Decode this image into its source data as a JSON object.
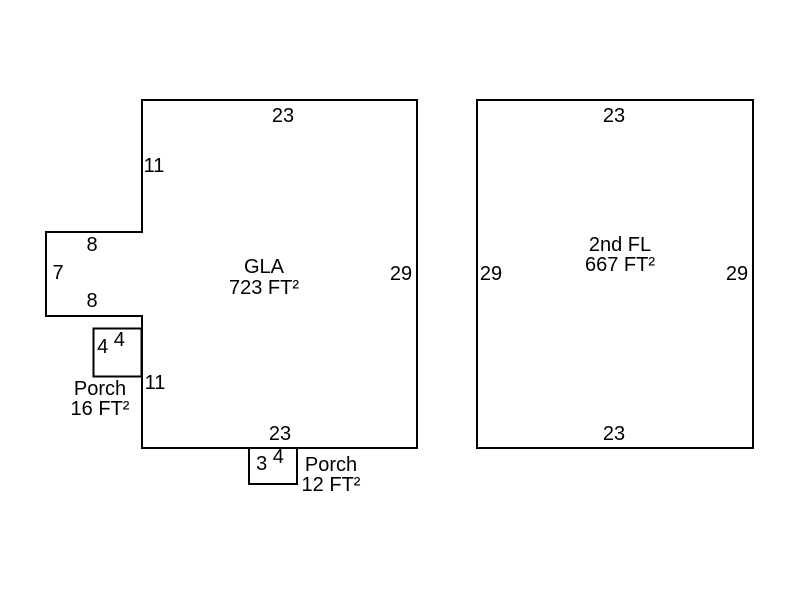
{
  "sketch": {
    "colors": {
      "line": "#000000",
      "text": "#000000",
      "background": "#ffffff"
    },
    "floor1": {
      "area_line1": "GLA",
      "area_line2": "723 FT²",
      "dim_top": "23",
      "dim_left_upper": "11",
      "dim_bump_top": "8",
      "dim_bump_left": "7",
      "dim_bump_bottom": "8",
      "dim_right": "29",
      "dim_left_lower": "11",
      "dim_bottom": "23",
      "porch_side": {
        "dim_a": "4",
        "dim_b": "4",
        "label_line1": "Porch",
        "label_line2": "16 FT²"
      },
      "porch_front": {
        "dim_a": "3",
        "dim_b": "4",
        "label_line1": "Porch",
        "label_line2": "12 FT²"
      }
    },
    "floor2": {
      "area_line1": "2nd FL",
      "area_line2": "667 FT²",
      "dim_top": "23",
      "dim_left": "29",
      "dim_right": "29",
      "dim_bottom": "23"
    }
  }
}
